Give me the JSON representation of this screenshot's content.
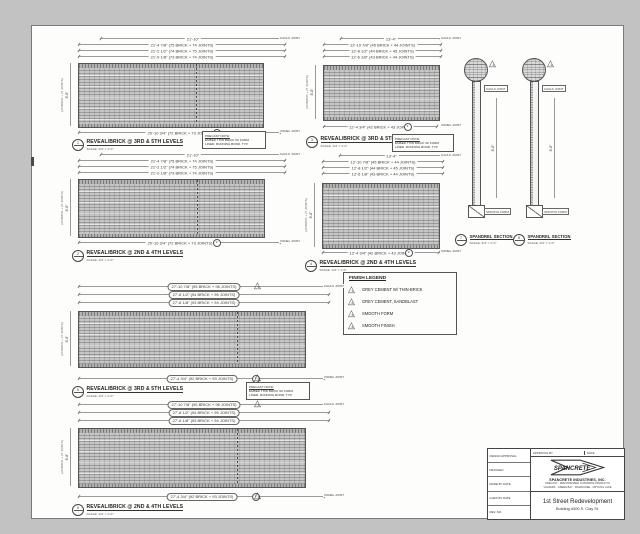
{
  "colors": {
    "paper": "#fdfdfc",
    "background": "#c2c2c2",
    "line": "#555555",
    "brick": "#c6c6c6"
  },
  "note_box": {
    "lines": [
      "PRECAST NOTE:",
      "EMBED THIN BRICK W/ FORM",
      "LINER. RUNNING BOND, TYP."
    ]
  },
  "legend": {
    "title": "FINISH LEGEND",
    "items": [
      {
        "num": "1",
        "label": "GREY CEMENT W/ THIN-BRICK"
      },
      {
        "num": "2",
        "label": "GREY CEMENT, SANDBLAST"
      },
      {
        "num": "3",
        "label": "SMOOTH FORM"
      },
      {
        "num": "4",
        "label": "SMOOTH FINISH"
      }
    ]
  },
  "elevations": [
    {
      "marker": "1",
      "caption": "REVEAL/BRICK @ 3RD & 5TH LEVELS",
      "scale": "SCALE: 1/4\" = 1'-0\"",
      "dims": [
        "21'-10\"",
        "21'-4 7/8\" (75 BRICK + 74 JOINTS)",
        "21'-2 1/2\" (74 BRICK + 75 JOINTS)",
        "21'-0 1/8\" (73 BRICK + 74 JOINTS)"
      ],
      "dim_bottom": "20'-10 3/4\" (72 BRICK + 73 JOINTS)",
      "bubble": "2",
      "dim_left": "8'-8\"",
      "dim_left_sub": "(26 BRICK + 27 JOINTS)",
      "joint_top": "CAULK JOINT",
      "joint_bottom": "PANEL JOINT"
    },
    {
      "marker": "2",
      "caption": "REVEAL/BRICK @ 2ND & 4TH LEVELS",
      "scale": "SCALE: 1/4\" = 1'-0\"",
      "dims": [
        "21'-10\"",
        "21'-4 7/8\" (75 BRICK + 74 JOINTS)",
        "21'-2 1/2\" (74 BRICK + 75 JOINTS)",
        "21'-0 1/8\" (73 BRICK + 74 JOINTS)"
      ],
      "dim_bottom": "20'-10 3/4\" (72 BRICK + 73 JOINTS)",
      "bubble": "2",
      "dim_left": "8'-8\"",
      "dim_left_sub": "(26 BRICK + 27 JOINTS)",
      "joint_top": "CAULK JOINT",
      "joint_bottom": "PANEL JOINT"
    },
    {
      "marker": "3",
      "caption": "REVEAL/BRICK @ 3RD & 5TH LEVELS",
      "scale": "SCALE: 1/4\" = 1'-0\"",
      "dims": [
        "13'-4\"",
        "12'-10 7/8\" (45 BRICK + 44 JOINTS)",
        "12'-8 1/2\" (44 BRICK + 45 JOINTS)",
        "12'-6 1/8\" (43 BRICK + 44 JOINTS)"
      ],
      "dim_bottom": "12'-4 3/4\" (42 BRICK + 43 JOINTS)",
      "bubble": "2",
      "dim_left": "8'-8\"",
      "dim_left_sub": "(26 BRICK + 27 JOINTS)",
      "joint_top": "CAULK JOINT",
      "joint_bottom": "PANEL JOINT"
    },
    {
      "marker": "4",
      "caption": "REVEAL/BRICK @ 2ND & 4TH LEVELS",
      "scale": "SCALE: 1/4\" = 1'-0\"",
      "dims": [
        "13'-4\"",
        "12'-10 7/8\" (45 BRICK + 44 JOINTS)",
        "12'-8 1/2\" (44 BRICK + 45 JOINTS)",
        "12'-6 1/8\" (43 BRICK + 44 JOINTS)"
      ],
      "dim_bottom": "12'-4 3/4\" (42 BRICK + 43 JOINTS)",
      "bubble": "2",
      "dim_left": "8'-8\"",
      "dim_left_sub": "(26 BRICK + 27 JOINTS)",
      "joint_top": "CAULK JOINT",
      "joint_bottom": "PANEL JOINT"
    },
    {
      "marker": "5",
      "caption": "REVEAL/BRICK @ 3RD & 5TH LEVELS",
      "scale": "SCALE: 1/4\" = 1'-0\"",
      "dims": [
        "27'-10 7/8\" (95 BRICK + 96 JOINTS)",
        "27'-8 1/2\" (94 BRICK + 95 JOINTS)",
        "27'-6 1/8\" (93 BRICK + 94 JOINTS)"
      ],
      "dim_bottom": "27'-4 3/4\" (92 BRICK + 93 JOINTS)",
      "bubble": "3",
      "tri": "1",
      "dim_left": "8'-8\"",
      "dim_left_sub": "(26 BRICK + 27 JOINTS)",
      "joint_top": "CAULK JOINT",
      "joint_bottom": "PANEL JOINT"
    },
    {
      "marker": "6",
      "caption": "REVEAL/BRICK @ 2ND & 4TH LEVELS",
      "scale": "SCALE: 1/4\" = 1'-0\"",
      "dims": [
        "27'-10 7/8\" (95 BRICK + 96 JOINTS)",
        "27'-8 1/2\" (94 BRICK + 95 JOINTS)",
        "27'-6 1/8\" (93 BRICK + 94 JOINTS)"
      ],
      "dim_bottom": "27'-4 3/4\" (92 BRICK + 93 JOINTS)",
      "bubble": "3",
      "tri": "1",
      "dim_left": "8'-8\"",
      "dim_left_sub": "(26 BRICK + 27 JOINTS)",
      "joint_top": "CAULK JOINT",
      "joint_bottom": "PANEL JOINT"
    }
  ],
  "sections": [
    {
      "marker": "7",
      "caption": "SPANDREL SECTION",
      "scale": "SCALE: 3/4\" = 1'-0\"",
      "tri": "1",
      "top_label": "CAULK JOINT",
      "side_dim": "8'-8\"",
      "bottom_label": "SMOOTH FORM"
    },
    {
      "marker": "8",
      "caption": "SPANDREL SECTION",
      "scale": "SCALE: 3/4\" = 1'-0\"",
      "tri": "1",
      "top_label": "CAULK JOINT",
      "side_dim": "8'-8\"",
      "bottom_label": "SMOOTH FORM"
    }
  ],
  "title_block": {
    "approval_label": "APPROVAL BY",
    "date_label": "DATE",
    "logo_text": "SPANCRETE",
    "company": "SPANCRETE INDUSTRIES, INC.",
    "company_line2": "PRECAST · PRESTRESSED CONCRETE PRODUCTS",
    "company_line3": "VALDERS · GREEN BAY · MILWAUKEE · CRYSTAL LAKE",
    "project": "1st Street Redevelopment",
    "location": "Building #300 S. Clay St.",
    "info_rows": [
      "DESIGN APPROVAL",
      "DETAILED",
      "MADE BY      DATE",
      "CHKD BY      DATE",
      "REV.      NO."
    ]
  }
}
